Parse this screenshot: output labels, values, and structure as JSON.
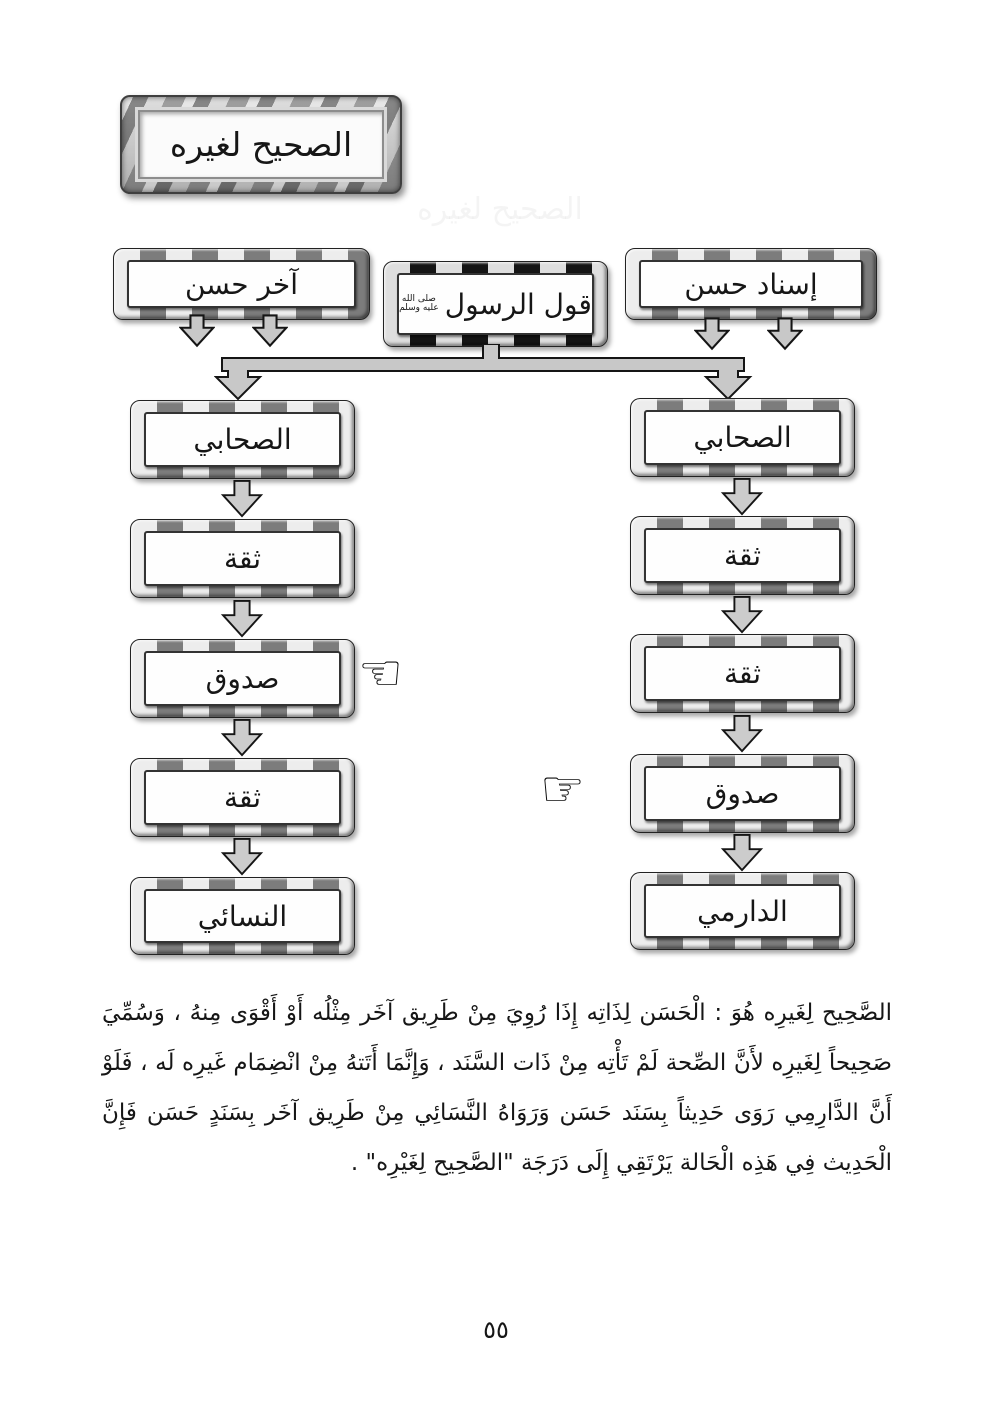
{
  "page": {
    "number_label": "٥٥"
  },
  "colors": {
    "background": "#ffffff",
    "frame_light": "#ededed",
    "frame_dark": "#7c7c7c",
    "center_frame_dark": "#151515",
    "arrow_fill": "#c8c8c8",
    "text": "#161616"
  },
  "icons": {
    "pointer_left_glyph": "☜",
    "pointer_right_glyph": "☞"
  },
  "title_banner": {
    "label": "الصحيح لغيره"
  },
  "ghost_text": {
    "label": "الصحيح لغيره"
  },
  "top_row": {
    "right_box": {
      "label": "إسناد حسن"
    },
    "center_box": {
      "label": "قول الرسول",
      "honorific_lines": [
        "صلى الله",
        "عليه وسلم"
      ]
    },
    "left_box": {
      "label": "آخر حسن"
    }
  },
  "left_chain": {
    "boxes": [
      "الصحابي",
      "ثقة",
      "صدوق",
      "ثقة",
      "النسائي"
    ],
    "pointer_target": "صدوق"
  },
  "right_chain": {
    "boxes": [
      "الصحابي",
      "ثقة",
      "ثقة",
      "صدوق",
      "الدارمي"
    ],
    "pointer_target": "صدوق"
  },
  "paragraph": {
    "lines": [
      "الصَّحِيح لِغَيرِه هُوَ : الْحَسَن لِذَاتِه إِذَا رُوِيَ مِنْ طَرِيق آخَر مِثْلُه أَوْ أَقْوَى مِنهُ ، وَسُمِّيَ",
      "صَحِيحاً لِغَيرِه لأَنَّ الصِّحة لَمْ تَأْتِه مِنْ ذَات السَّنَد ، وَإِنَّمَا أَتَتهُ مِنْ انْضِمَام غَيرِه لَه ، فَلَوْ",
      "أَنَّ الدَّارِمِي رَوَى حَدِيثاً بِسَنَد حَسَن وَرَوَاهُ النَّسَائِي مِنْ طَرِيق آخَر بِسَنَدٍ حَسَن فَإِنَّ",
      "الْحَدِيث فِي هَذِه الْحَالة يَرْتَقِي إِلَى دَرَجَة \"الصَّحِيح لِغَيْرِه\" ."
    ]
  }
}
